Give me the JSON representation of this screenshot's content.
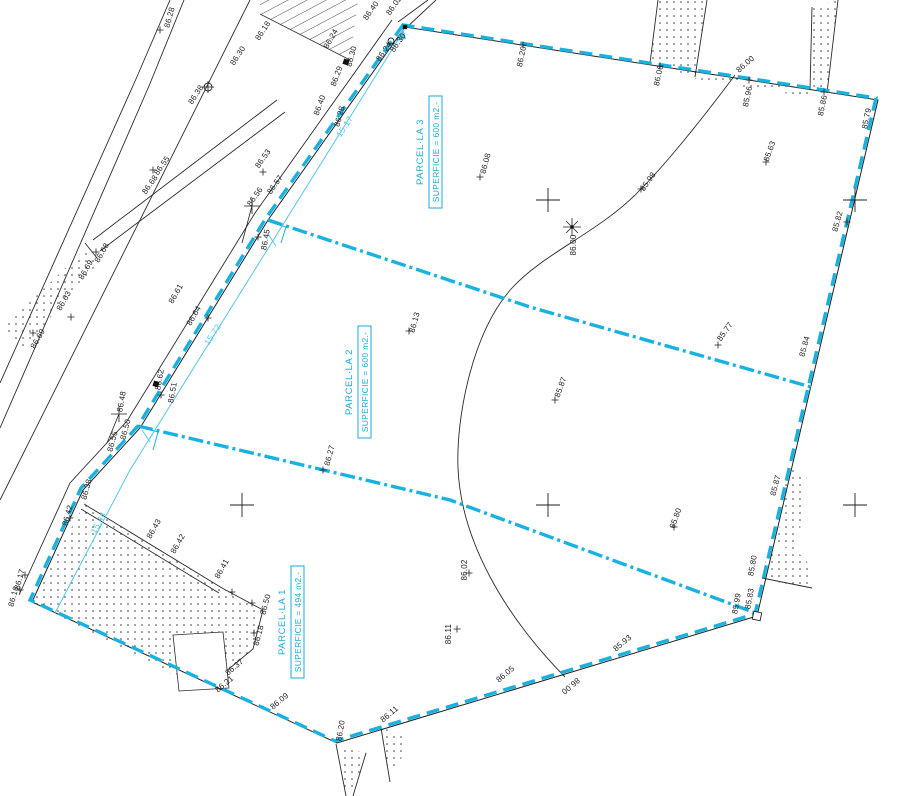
{
  "drawing_title": "Parcel subdivision site plan",
  "colors": {
    "boundary_cyan": "#18b2e0",
    "dim_cyan": "#55c6e8",
    "parcel_text_cyan": "#19aed8",
    "line_black": "#222222",
    "background": "#ffffff"
  },
  "parcels": [
    {
      "name": "PARCEL·LA 3",
      "area_label": "SUPERFICIE = 600 m2.-",
      "x": 423,
      "y": 152
    },
    {
      "name": "PARCEL·LA 2",
      "area_label": "SUPERFICIE = 600 m2.-",
      "x": 352,
      "y": 382
    },
    {
      "name": "PARCEL·LA 1",
      "area_label": "SUPERFICIE = 494 m2.-",
      "x": 285,
      "y": 622
    }
  ],
  "dimensions": [
    {
      "text": "15.17",
      "x": 347,
      "y": 128,
      "rot": -57
    },
    {
      "text": "15.72",
      "x": 215,
      "y": 336,
      "rot": -57
    },
    {
      "text": "15.44",
      "x": 101,
      "y": 524,
      "rot": -62
    }
  ],
  "spot_elevations": [
    {
      "t": "86.28",
      "x": 172,
      "y": 18,
      "r": -75
    },
    {
      "t": "86.18",
      "x": 265,
      "y": 32,
      "r": -57
    },
    {
      "t": "86.30",
      "x": 240,
      "y": 57,
      "r": -57
    },
    {
      "t": "86.38",
      "x": 198,
      "y": 96,
      "r": -57
    },
    {
      "t": "86.24",
      "x": 333,
      "y": 40,
      "r": -60
    },
    {
      "t": "86.30",
      "x": 354,
      "y": 57,
      "r": -75
    },
    {
      "t": "86.29",
      "x": 339,
      "y": 77,
      "r": -70
    },
    {
      "t": "86.40",
      "x": 322,
      "y": 106,
      "r": -70
    },
    {
      "t": "86.28",
      "x": 342,
      "y": 117,
      "r": -75
    },
    {
      "t": "86.40",
      "x": 373,
      "y": 12,
      "r": -55
    },
    {
      "t": "86.02",
      "x": 396,
      "y": 7,
      "r": -55
    },
    {
      "t": "86.24",
      "x": 386,
      "y": 53,
      "r": -55
    },
    {
      "t": "86.30",
      "x": 400,
      "y": 44,
      "r": -55
    },
    {
      "t": "86.20",
      "x": 524,
      "y": 57,
      "r": -78
    },
    {
      "t": "86.06",
      "x": 661,
      "y": 76,
      "r": -78
    },
    {
      "t": "86.00",
      "x": 747,
      "y": 66,
      "r": -42
    },
    {
      "t": "85.96",
      "x": 750,
      "y": 97,
      "r": -78
    },
    {
      "t": "85.86",
      "x": 825,
      "y": 106,
      "r": -78
    },
    {
      "t": "85.79",
      "x": 869,
      "y": 119,
      "r": -78
    },
    {
      "t": "85.63",
      "x": 772,
      "y": 152,
      "r": -70
    },
    {
      "t": "85.82",
      "x": 840,
      "y": 222,
      "r": -75
    },
    {
      "t": "85.84",
      "x": 807,
      "y": 347,
      "r": -75
    },
    {
      "t": "85.77",
      "x": 727,
      "y": 333,
      "r": -55
    },
    {
      "t": "85.98",
      "x": 650,
      "y": 183,
      "r": -55
    },
    {
      "t": "86.00",
      "x": 576,
      "y": 245,
      "r": -90
    },
    {
      "t": "86.08",
      "x": 488,
      "y": 164,
      "r": -75
    },
    {
      "t": "86.13",
      "x": 417,
      "y": 323,
      "r": -75
    },
    {
      "t": "85.87",
      "x": 563,
      "y": 388,
      "r": -70
    },
    {
      "t": "85.80",
      "x": 678,
      "y": 519,
      "r": -70
    },
    {
      "t": "85.87",
      "x": 778,
      "y": 486,
      "r": -75
    },
    {
      "t": "85.80",
      "x": 755,
      "y": 566,
      "r": -80
    },
    {
      "t": "85.83",
      "x": 752,
      "y": 599,
      "r": -80
    },
    {
      "t": "85.99",
      "x": 739,
      "y": 604,
      "r": -80
    },
    {
      "t": "85.93",
      "x": 624,
      "y": 645,
      "r": -40
    },
    {
      "t": "86.00",
      "x": 569,
      "y": 684,
      "r": 140
    },
    {
      "t": "86.05",
      "x": 507,
      "y": 676,
      "r": -40
    },
    {
      "t": "86.11",
      "x": 451,
      "y": 634,
      "r": -90
    },
    {
      "t": "86.02",
      "x": 467,
      "y": 570,
      "r": -90
    },
    {
      "t": "86.11",
      "x": 391,
      "y": 716,
      "r": -40
    },
    {
      "t": "86.20",
      "x": 343,
      "y": 731,
      "r": -80
    },
    {
      "t": "86.09",
      "x": 281,
      "y": 703,
      "r": -40
    },
    {
      "t": "86.37",
      "x": 236,
      "y": 669,
      "r": -40
    },
    {
      "t": "86.21",
      "x": 226,
      "y": 686,
      "r": -40
    },
    {
      "t": "86.18",
      "x": 261,
      "y": 636,
      "r": -75
    },
    {
      "t": "86.50",
      "x": 268,
      "y": 605,
      "r": -75
    },
    {
      "t": "86.41",
      "x": 224,
      "y": 570,
      "r": -60
    },
    {
      "t": "86.42",
      "x": 180,
      "y": 545,
      "r": -60
    },
    {
      "t": "86.43",
      "x": 156,
      "y": 530,
      "r": -60
    },
    {
      "t": "86.42",
      "x": 70,
      "y": 516,
      "r": -75
    },
    {
      "t": "86.38",
      "x": 89,
      "y": 490,
      "r": -75
    },
    {
      "t": "86.17",
      "x": 22,
      "y": 580,
      "r": -75
    },
    {
      "t": "86.16",
      "x": 16,
      "y": 597,
      "r": -75
    },
    {
      "t": "86.27",
      "x": 332,
      "y": 456,
      "r": -75
    },
    {
      "t": "86.50",
      "x": 128,
      "y": 430,
      "r": -75
    },
    {
      "t": "86.55",
      "x": 115,
      "y": 442,
      "r": -75
    },
    {
      "t": "86.48",
      "x": 124,
      "y": 402,
      "r": -80
    },
    {
      "t": "86.51",
      "x": 175,
      "y": 393,
      "r": -80
    },
    {
      "t": "86.62",
      "x": 162,
      "y": 380,
      "r": -80
    },
    {
      "t": "86.64",
      "x": 196,
      "y": 317,
      "r": -60
    },
    {
      "t": "86.61",
      "x": 178,
      "y": 295,
      "r": -60
    },
    {
      "t": "86.45",
      "x": 268,
      "y": 240,
      "r": -80
    },
    {
      "t": "86.56",
      "x": 257,
      "y": 198,
      "r": -55
    },
    {
      "t": "86.57",
      "x": 277,
      "y": 186,
      "r": -55
    },
    {
      "t": "86.53",
      "x": 265,
      "y": 160,
      "r": -55
    },
    {
      "t": "86.55",
      "x": 164,
      "y": 167,
      "r": -55
    },
    {
      "t": "86.68",
      "x": 152,
      "y": 186,
      "r": -55
    },
    {
      "t": "86.68",
      "x": 104,
      "y": 254,
      "r": -60
    },
    {
      "t": "86.69",
      "x": 88,
      "y": 271,
      "r": -60
    },
    {
      "t": "86.63",
      "x": 66,
      "y": 302,
      "r": -60
    },
    {
      "t": "86.69",
      "x": 40,
      "y": 340,
      "r": -60
    }
  ],
  "tick_points": [
    {
      "x": 160,
      "y": 30
    },
    {
      "x": 766,
      "y": 162
    },
    {
      "x": 718,
      "y": 345
    },
    {
      "x": 555,
      "y": 400
    },
    {
      "x": 674,
      "y": 527
    },
    {
      "x": 641,
      "y": 189
    },
    {
      "x": 480,
      "y": 177
    },
    {
      "x": 409,
      "y": 331
    },
    {
      "x": 323,
      "y": 470
    },
    {
      "x": 469,
      "y": 573
    },
    {
      "x": 457,
      "y": 629
    },
    {
      "x": 254,
      "y": 633
    },
    {
      "x": 25,
      "y": 575
    },
    {
      "x": 20,
      "y": 590
    },
    {
      "x": 70,
      "y": 518
    },
    {
      "x": 96,
      "y": 252
    },
    {
      "x": 71,
      "y": 317
    },
    {
      "x": 33,
      "y": 333
    },
    {
      "x": 153,
      "y": 170
    },
    {
      "x": 263,
      "y": 172
    },
    {
      "x": 258,
      "y": 237
    },
    {
      "x": 208,
      "y": 318
    },
    {
      "x": 161,
      "y": 395
    },
    {
      "x": 523,
      "y": 45
    },
    {
      "x": 660,
      "y": 66
    },
    {
      "x": 749,
      "y": 80
    },
    {
      "x": 824,
      "y": 92
    },
    {
      "x": 232,
      "y": 592
    },
    {
      "x": 252,
      "y": 603
    },
    {
      "x": 847,
      "y": 222
    }
  ],
  "grid_crosses": [
    {
      "x": 548,
      "y": 200
    },
    {
      "x": 855,
      "y": 200
    },
    {
      "x": 548,
      "y": 505
    },
    {
      "x": 242,
      "y": 505
    },
    {
      "x": 855,
      "y": 505
    }
  ],
  "stations": {
    "filled_squares": [
      {
        "x": 346,
        "y": 62
      },
      {
        "x": 156,
        "y": 384
      }
    ],
    "circle_plus": [
      {
        "x": 208,
        "y": 87
      }
    ],
    "small_circles": [
      {
        "x": 391,
        "y": 41
      }
    ],
    "star_points": [
      {
        "x": 572,
        "y": 227
      }
    ],
    "benchmarks": [
      {
        "x": 252,
        "y": 206,
        "tx": 242,
        "ty": 243
      },
      {
        "x": 119,
        "y": 414,
        "tx": 107,
        "ty": 443
      }
    ],
    "open_square": {
      "x": 757,
      "y": 616
    },
    "corner_dot": {
      "x": 405,
      "y": 27
    }
  }
}
